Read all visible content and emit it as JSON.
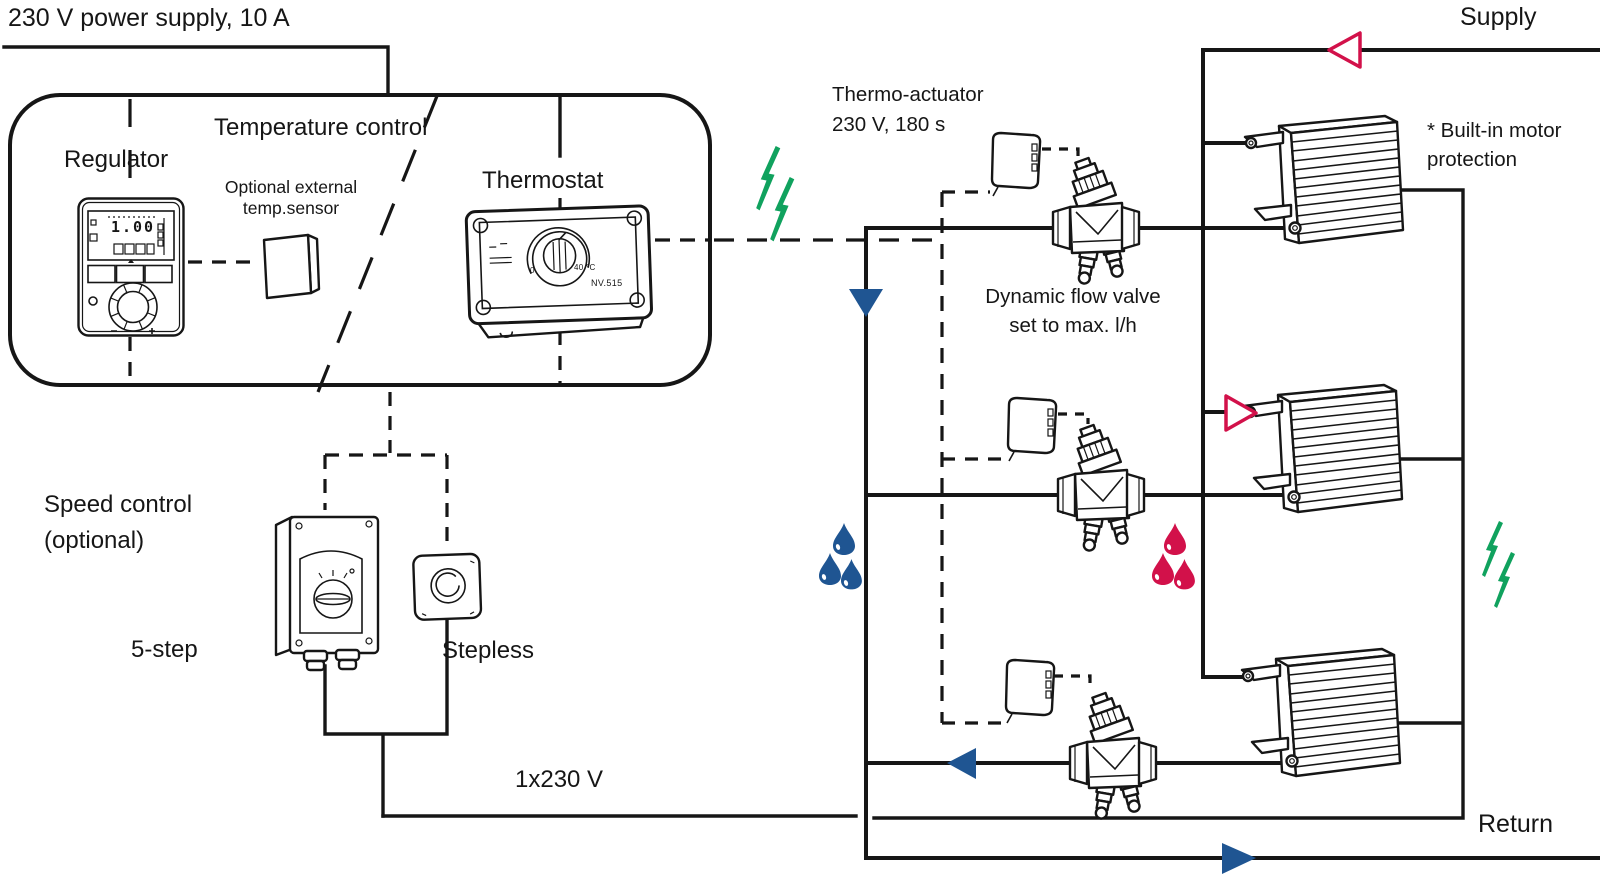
{
  "colors": {
    "line": "#161616",
    "signal_green": "#10a25e",
    "water_blue": "#1f5592",
    "water_red": "#d2114a",
    "background": "#ffffff"
  },
  "power": {
    "supply_label": "230 V power supply, 10 A",
    "mains_label": "1x230 V"
  },
  "piping": {
    "supply_label": "Supply",
    "return_label": "Return"
  },
  "temperature_control": {
    "group_label": "Temperature control",
    "regulator_label": "Regulator",
    "regulator_display": "1.00",
    "sensor_label_line1": "Optional external",
    "sensor_label_line2": "temp.sensor",
    "thermostat_label": "Thermostat",
    "thermostat_scale_min": "0",
    "thermostat_scale_max": "40 °C",
    "thermostat_model": "NV.515"
  },
  "thermo_actuator": {
    "label_line1": "Thermo-actuator",
    "label_line2": "230 V, 180 s"
  },
  "flow_valve": {
    "label_line1": "Dynamic flow valve",
    "label_line2": "set to max. l/h"
  },
  "heaters": {
    "count": 3,
    "note_line1": "* Built-in motor",
    "note_line2": "protection"
  },
  "speed_control": {
    "label_line1": "Speed control",
    "label_line2": "(optional)",
    "five_step_label": "5-step",
    "stepless_label": "Stepless"
  },
  "icons": {
    "radio-signal-icon": "double green lightning bolt",
    "hot-water-icon": "three red drops",
    "cold-water-icon": "three blue drops",
    "supply-flow-arrow": "open red triangle",
    "return-flow-arrow": "solid blue triangle"
  }
}
